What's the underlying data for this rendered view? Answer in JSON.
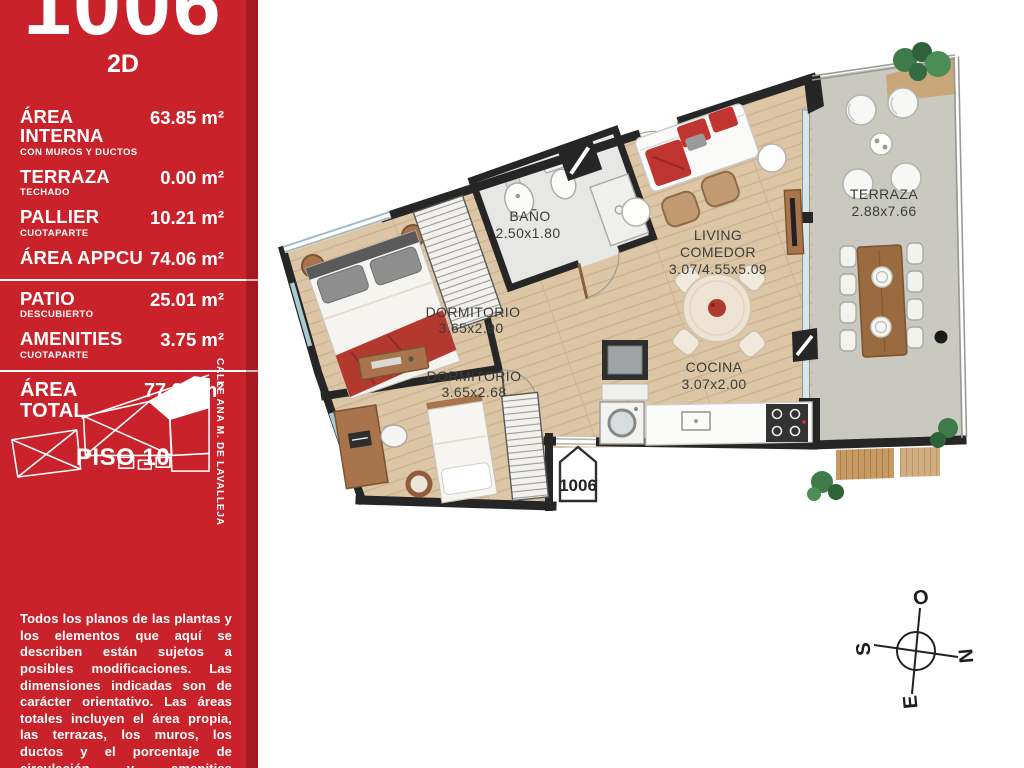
{
  "sidebar": {
    "unit_number": "1006",
    "view_label": "2D",
    "rows": [
      {
        "label": "ÁREA INTERNA",
        "sublabel": "CON MUROS Y DUCTOS",
        "value": "63.85 m²"
      },
      {
        "label": "TERRAZA",
        "sublabel": "TECHADO",
        "value": "0.00 m²"
      },
      {
        "label": "PALLIER",
        "sublabel": "CUOTAPARTE",
        "value": "10.21 m²"
      },
      {
        "label": "ÁREA APPCU",
        "sublabel": "",
        "value": "74.06 m²"
      },
      {
        "label": "PATIO",
        "sublabel": "DESCUBIERTO",
        "value": "25.01 m²"
      },
      {
        "label": "AMENITIES",
        "sublabel": "CUOTAPARTE",
        "value": "3.75 m²"
      },
      {
        "label": "ÁREA TOTAL",
        "sublabel": "",
        "value": "77.81 m²"
      }
    ],
    "floor_label": "PISO 10",
    "street_label": "CALLE ANA M. DE LAVALLEJA",
    "disclaimer": "Todos los planos de las plantas y los elementos que aquí se describen están sujetos a posibles modificaciones. Las dimensiones indicadas son de carácter orientativo. Las áreas totales incluyen el área propia, las terrazas, los muros, los ductos y el porcentaje de circulación y amenities correspondiente a cada unidad."
  },
  "plan": {
    "rooms": [
      {
        "name": "BAÑO",
        "dims": "2.50x1.80"
      },
      {
        "name": "DORMITORIO",
        "dims": "3.65x2.90"
      },
      {
        "name": "DORMITORIO",
        "dims": "3.65x2.68"
      },
      {
        "name_line1": "LIVING",
        "name_line2": "COMEDOR",
        "dims": "3.07/4.55x5.09"
      },
      {
        "name": "COCINA",
        "dims": "3.07x2.00"
      },
      {
        "name": "TERRAZA",
        "dims": "2.88x7.66"
      }
    ],
    "unit_marker": "1006",
    "compass": {
      "west": "O",
      "south": "S",
      "north": "N",
      "east": "E"
    }
  },
  "colors": {
    "sidebar_red": "#C9222B",
    "wall": "#262626",
    "wood_floor": "#DCC6A6",
    "bath_floor": "#E7E7E5",
    "terrace_floor": "#C9C9C2",
    "accent_red": "#B3392F",
    "glass": "#D6E7EA"
  }
}
